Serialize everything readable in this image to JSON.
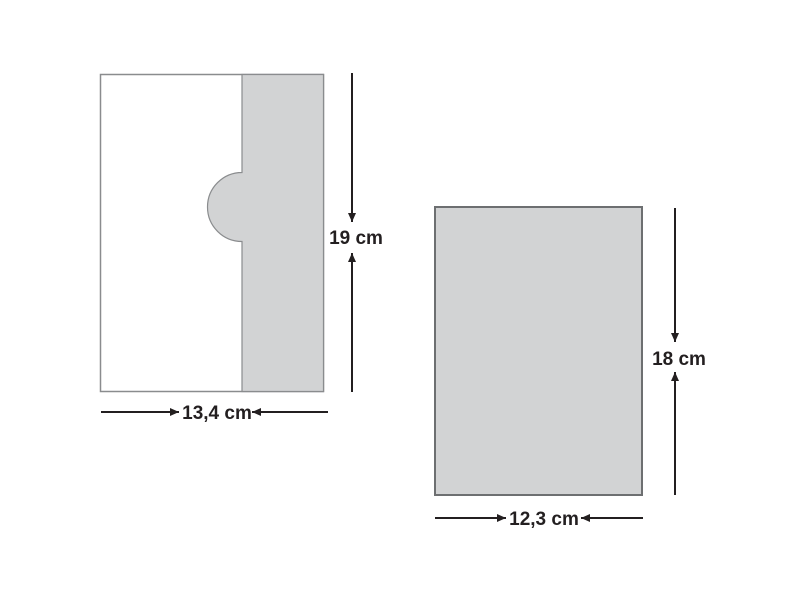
{
  "diagram": {
    "left_shape": {
      "height_label": "19 cm",
      "width_label": "13,4 cm",
      "height_cm": 19,
      "width_cm": 13.4
    },
    "right_shape": {
      "height_label": "18 cm",
      "width_label": "12,3 cm",
      "height_cm": 18,
      "width_cm": 12.3
    }
  },
  "colors": {
    "background": "#ffffff",
    "shape_fill": "#d2d3d4",
    "left_shape_stroke": "#8a8c8e",
    "right_shape_stroke": "#6d6f71",
    "dimension_color": "#231f20"
  }
}
